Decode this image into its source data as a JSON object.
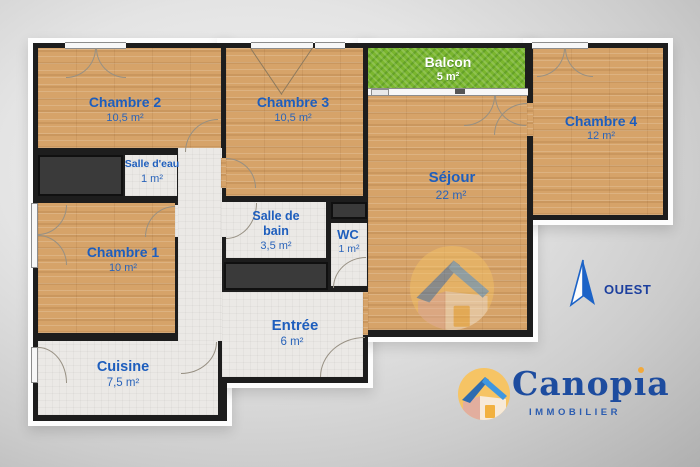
{
  "rooms": {
    "chambre2": {
      "name": "Chambre 2",
      "area": "10,5 m²"
    },
    "chambre3": {
      "name": "Chambre 3",
      "area": "10,5 m²"
    },
    "chambre4": {
      "name": "Chambre 4",
      "area": "12 m²"
    },
    "chambre1": {
      "name": "Chambre 1",
      "area": "10 m²"
    },
    "balcon": {
      "name": "Balcon",
      "area": "5 m²"
    },
    "sejour": {
      "name": "Séjour",
      "area": "22 m²"
    },
    "salle_deau": {
      "name": "Salle d'eau",
      "area": "1 m²"
    },
    "salle_de_bain": {
      "name_line1": "Salle de",
      "name_line2": "bain",
      "area": "3,5 m²"
    },
    "wc": {
      "name": "WC",
      "area": "1 m²"
    },
    "entree": {
      "name": "Entrée",
      "area": "6 m²"
    },
    "cuisine": {
      "name": "Cuisine",
      "area": "7,5 m²"
    }
  },
  "compass": {
    "direction": "OUEST"
  },
  "logo": {
    "brand_pre": "Canop",
    "brand_i": "ı",
    "brand_post": "a",
    "tagline": "IMMOBILIER"
  },
  "colors": {
    "label_blue": "#1e5ebd",
    "wall": "#1d1d1d",
    "wood": "#d6a369",
    "balcony_green": "#7ab62e",
    "brand_blue": "#1d4c9f",
    "accent_orange": "#f2a93b"
  }
}
